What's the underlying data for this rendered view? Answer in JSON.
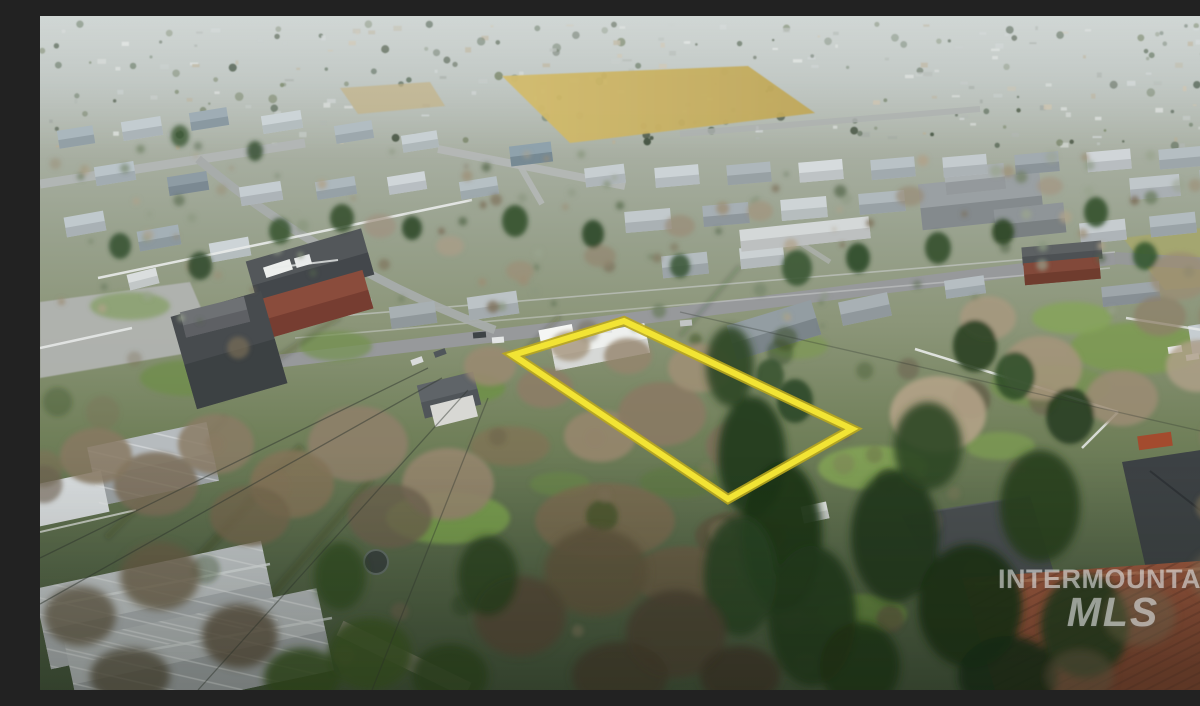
{
  "watermark": {
    "line1": "INTERMOUNTAIN",
    "line2": "MLS",
    "color": "rgba(238,241,241,0.55)"
  },
  "boundary": {
    "points": "473,339 584,305 812,413 688,483",
    "stroke_color": "#f2e434",
    "outline_color": "#b9a71e"
  }
}
